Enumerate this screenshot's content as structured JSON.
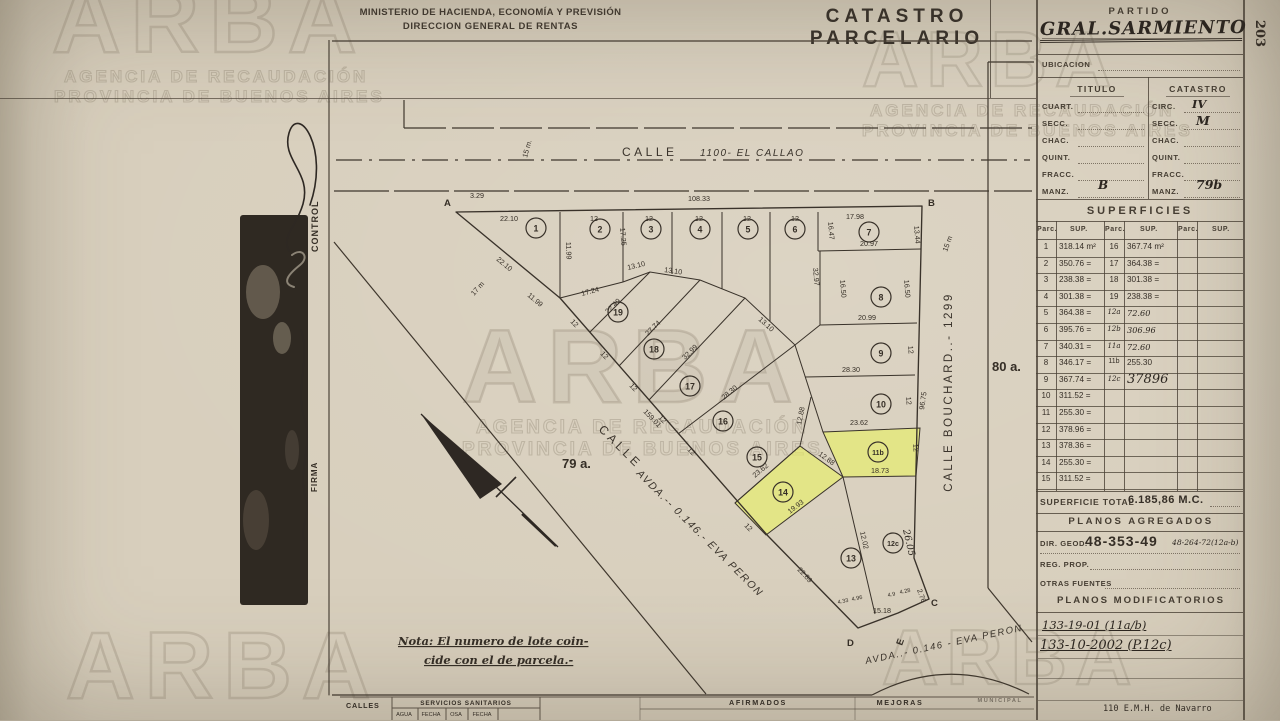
{
  "header": {
    "ministry_line1": "MINISTERIO DE HACIENDA, ECONOMÍA Y PREVISIÓN",
    "ministry_line2": "DIRECCION GENERAL DE RENTAS",
    "title": "CATASTRO PARCELARIO",
    "page_number": "203"
  },
  "partido": {
    "label": "PARTIDO",
    "value": "GRAL.SARMIENTO",
    "ubicacion": "UBICACION",
    "titulo": "TITULO",
    "catastro": "CATASTRO",
    "left_labels": [
      "CUART.",
      "SECC.",
      "CHAC.",
      "QUINT.",
      "FRACC.",
      "MANZ."
    ],
    "left_values": [
      "",
      "",
      "",
      "",
      "",
      "B"
    ],
    "right_labels": [
      "CIRC.",
      "SECC.",
      "CHAC.",
      "QUINT.",
      "FRACC.",
      "MANZ."
    ],
    "right_values": [
      "IV",
      "M",
      "",
      "",
      "",
      "79b"
    ]
  },
  "superficies": {
    "title": "SUPERFICIES",
    "parc_h": "Parc.",
    "sup_h": "SUP.",
    "col1": [
      {
        "p": "1",
        "s": "318.14 m²"
      },
      {
        "p": "2",
        "s": "350.76 ="
      },
      {
        "p": "3",
        "s": "238.38 ="
      },
      {
        "p": "4",
        "s": "301.38 ="
      },
      {
        "p": "5",
        "s": "364.38 ="
      },
      {
        "p": "6",
        "s": "395.76 ="
      },
      {
        "p": "7",
        "s": "340.31 ="
      },
      {
        "p": "8",
        "s": "346.17 ="
      },
      {
        "p": "9",
        "s": "367.74 ="
      },
      {
        "p": "10",
        "s": "311.52 ="
      },
      {
        "p": "11",
        "s": "255.30 ="
      },
      {
        "p": "12",
        "s": "378.96 ="
      },
      {
        "p": "13",
        "s": "378.36 ="
      },
      {
        "p": "14",
        "s": "255.30 ="
      },
      {
        "p": "15",
        "s": "311.52 ="
      }
    ],
    "col2": [
      {
        "p": "16",
        "s": "367.74 m²"
      },
      {
        "p": "17",
        "s": "364.38 ="
      },
      {
        "p": "18",
        "s": "301.38 ="
      },
      {
        "p": "19",
        "s": "238.38 ="
      },
      {
        "p": "12a",
        "s": "72.60"
      },
      {
        "p": "12b",
        "s": "306.96"
      },
      {
        "p": "11a",
        "s": "72.60"
      },
      {
        "p": "11b",
        "s": "255.30"
      },
      {
        "p": "12c",
        "s": "37896"
      }
    ],
    "total_label": "SUPERFICIE TOTAL",
    "total_value": "6.185,86 M.C."
  },
  "planos": {
    "agregados": "PLANOS AGREGADOS",
    "dir_geod": "DIR. GEOD.",
    "dir_val": "48-353-49",
    "dir_note": "48-264-72(12a-b)",
    "reg_prop": "REG. PROP.",
    "otras": "OTRAS FUENTES",
    "modificatorios": "PLANOS MODIFICATORIOS",
    "m1": "133-19-01 (11a/b)",
    "m2": "133-10-2002 (P.12c)",
    "footer": "110 E.M.H. de Navarro"
  },
  "left_strip": {
    "control": "CONTROL",
    "firma": "FIRMA"
  },
  "map": {
    "street_top": "CALLE",
    "street_top_detail": "1100-  EL CALLAO",
    "street_diag_a": "CALLE",
    "street_diag_b": "AVDA.-- 0.146.- EVA PERON",
    "street_right": "CALLE    BOUCHARD..- 1299",
    "street_bottom": "AVDA..- 0.146 -  EVA PERON",
    "area_left": "79 a.",
    "area_right": "80 a.",
    "note1": "Nota: El numero de lote coin-",
    "note2": "cide con el de parcela.-",
    "corners": [
      "A",
      "B",
      "C",
      "D",
      "E"
    ],
    "widths": [
      "15 m.",
      "17 m",
      "15 m"
    ],
    "lots": [
      "1",
      "2",
      "3",
      "4",
      "5",
      "6",
      "7",
      "8",
      "9",
      "10",
      "11b",
      "12c",
      "13",
      "14",
      "15",
      "16",
      "17",
      "18",
      "19"
    ],
    "dims": [
      "108.33",
      "22.10",
      "12",
      "12",
      "12",
      "12",
      "12",
      "17.98",
      "3.29",
      "22.10",
      "11.99",
      "11.99",
      "17.25",
      "17.24",
      "22.49",
      "27.74",
      "32.99",
      "28.30",
      "23.62",
      "13.10",
      "13.10",
      "13.10",
      "12",
      "12",
      "12",
      "12",
      "12",
      "159.01",
      "12",
      "20.97",
      "16.47",
      "13.44",
      "16.50",
      "16.50",
      "20.99",
      "12",
      "28.30",
      "12",
      "23.62",
      "96.75",
      "12",
      "18.73",
      "12.88",
      "12.88",
      "19.93",
      "22.89",
      "12.02",
      "26.05",
      "15.18",
      "2.76",
      "4.33",
      "4.96",
      "4.9",
      "4.28",
      "32.97"
    ]
  },
  "bottom_table": {
    "calles": "CALLES",
    "servicios": "SERVICIOS SANITARIOS",
    "sub": [
      "AGUA",
      "FECHA",
      "OSA",
      "FECHA"
    ],
    "afirmados": "AFIRMADOS",
    "mejoras": "MEJORAS",
    "municipal": "MUNICIPAL"
  },
  "watermark": {
    "brand": "ARBA",
    "line1": "AGENCIA DE RECAUDACIÓN",
    "line2": "PROVINCIA DE BUENOS AIRES"
  },
  "colors": {
    "highlight": "#e9f063",
    "paper": "#d8cfbd",
    "ink": "#3f372d"
  }
}
